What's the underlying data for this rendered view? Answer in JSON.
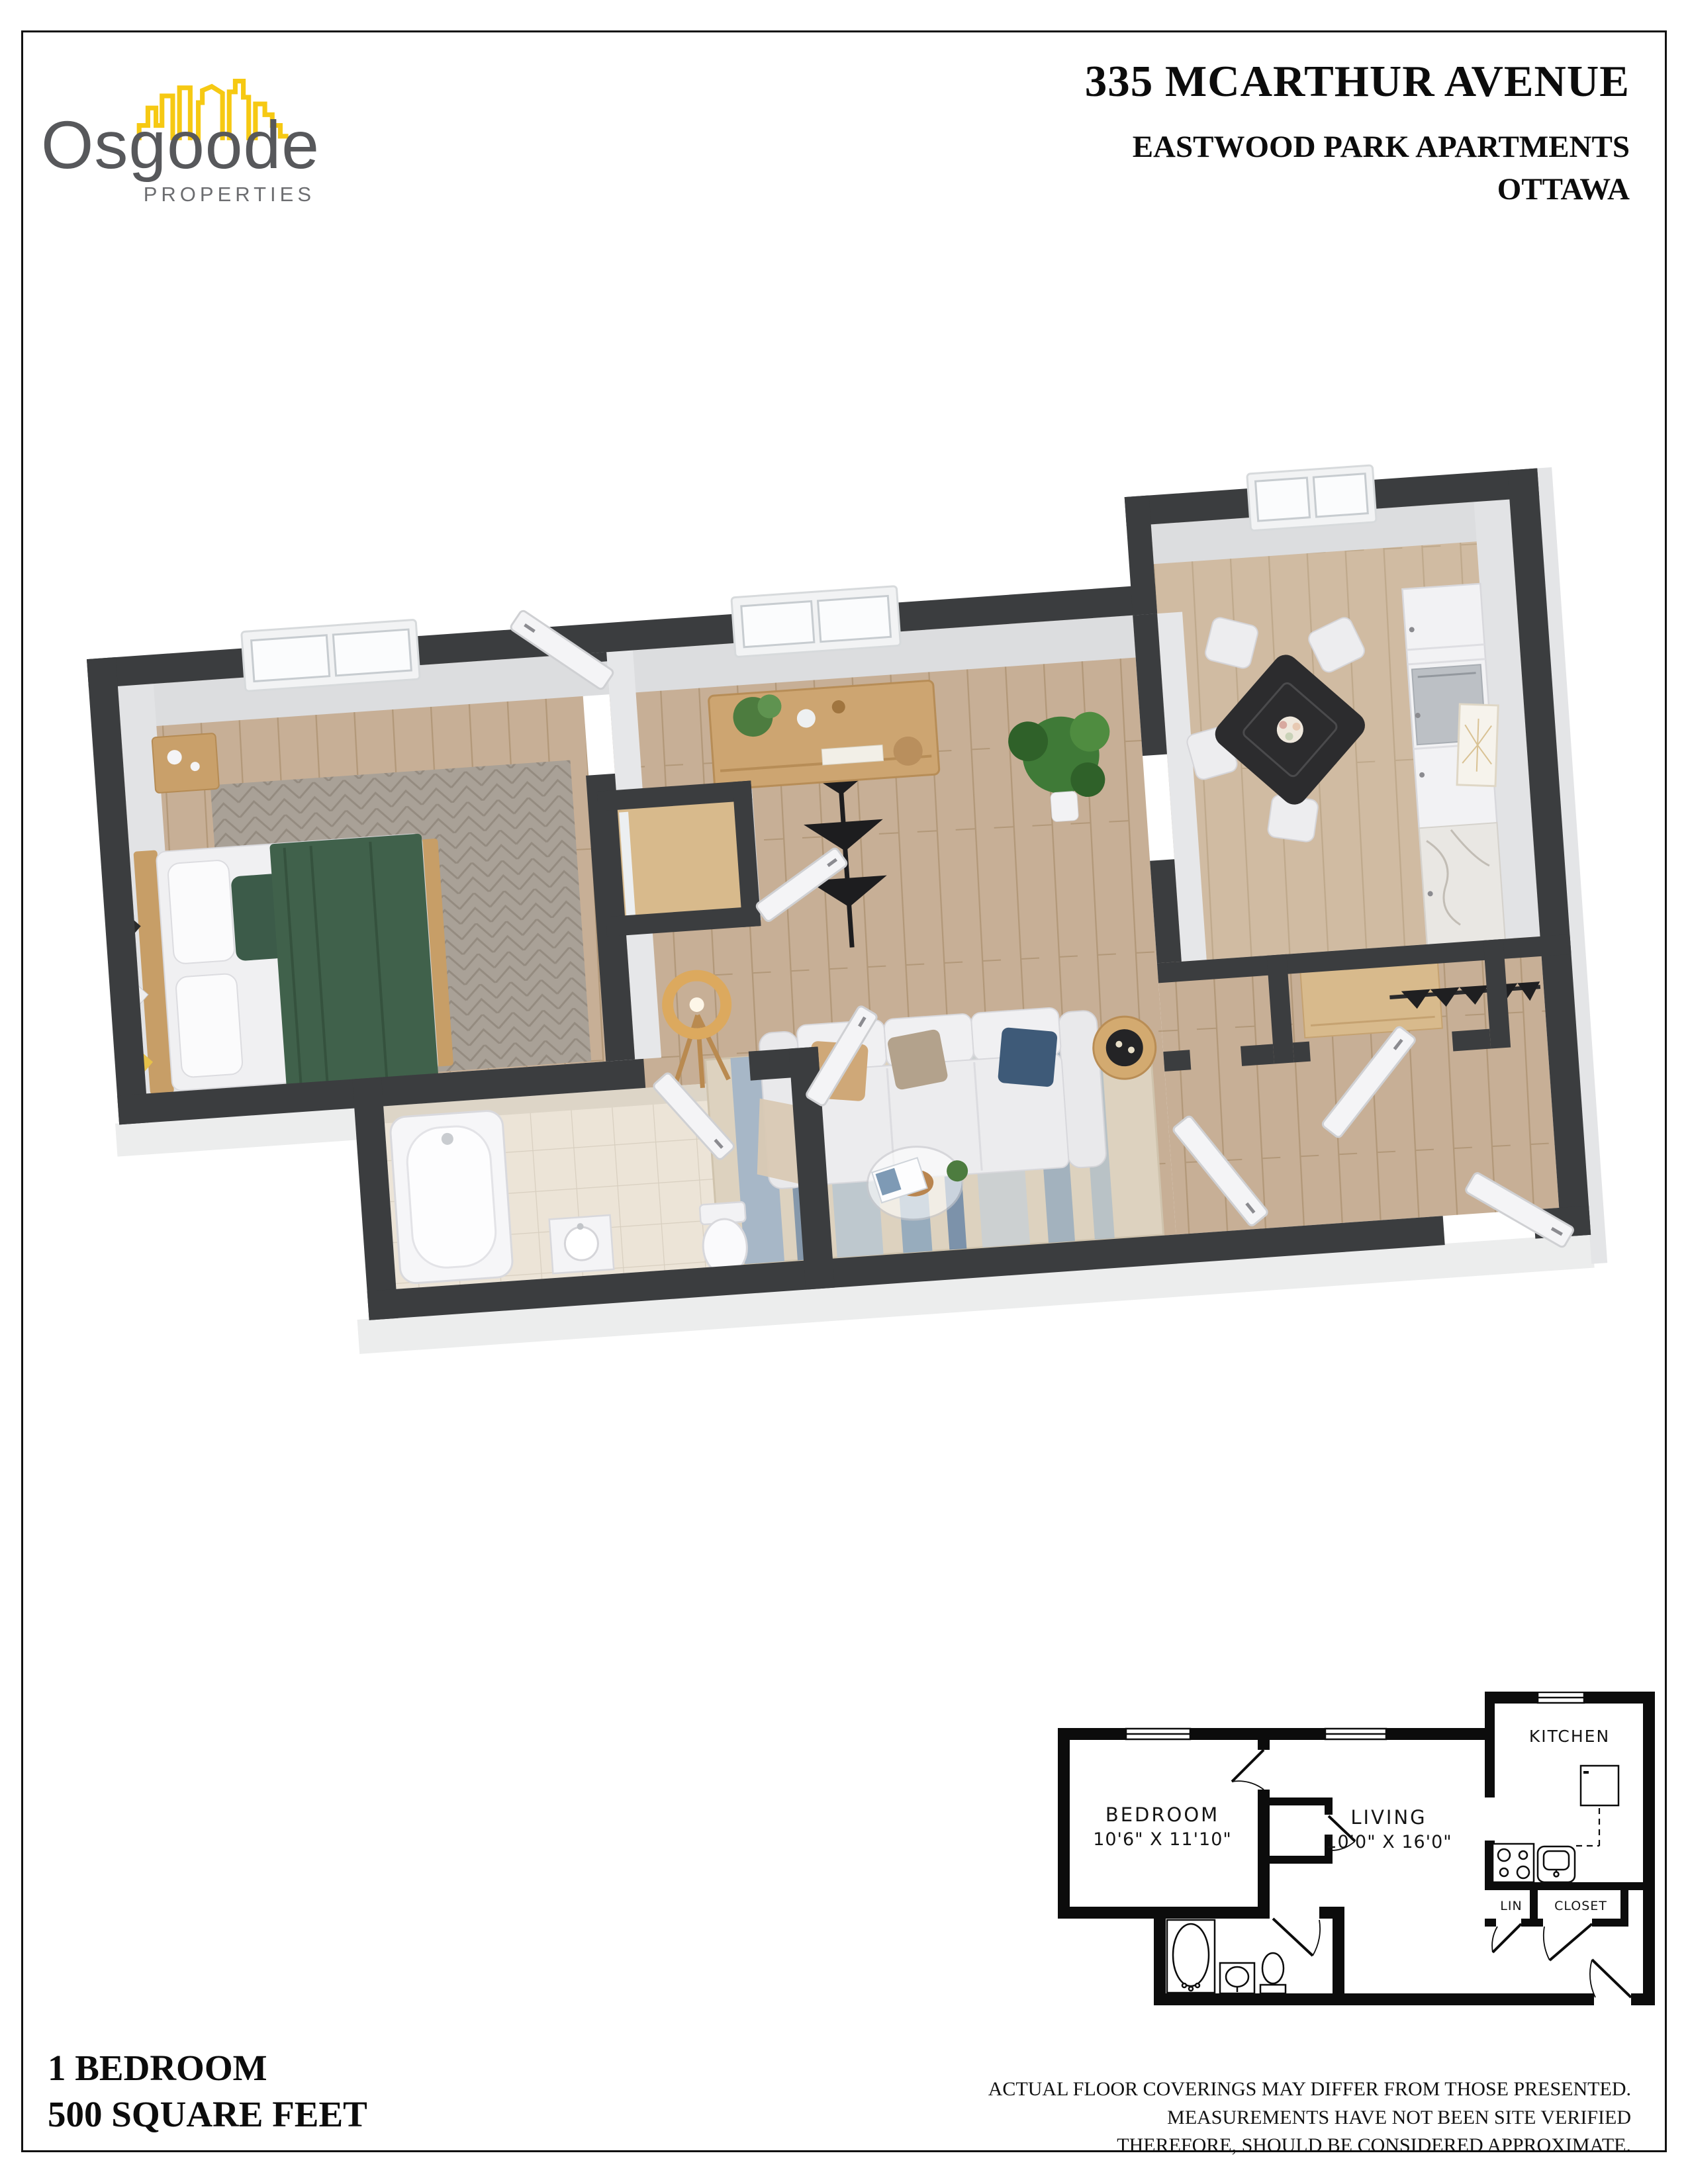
{
  "theme": {
    "accent_yellow": "#f6c913",
    "logo_gray": "#57585b",
    "wall_dark": "#3b3d3f",
    "wood_floor": "#c7af96",
    "tile_floor": "#ece4d7",
    "rug_blue": "#8fa7bd",
    "blanket_green": "#40614b"
  },
  "header": {
    "logo_name": "Osgoode",
    "logo_subtitle": "PROPERTIES",
    "address": "335 MCARTHUR AVENUE",
    "building": "EASTWOOD PARK APARTMENTS",
    "city": "OTTAWA"
  },
  "floorplan_2d": {
    "bedroom_label": "BEDROOM",
    "bedroom_dims": "10'6\" X 11'10\"",
    "living_label": "LIVING",
    "living_dims": "10'0\" X 16'0\"",
    "kitchen_label": "KITCHEN",
    "lin_label": "LIN",
    "closet_label": "CLOSET"
  },
  "footer": {
    "unit_type": "1 BEDROOM",
    "unit_area": "500 SQUARE FEET",
    "disclaimer": [
      "ACTUAL FLOOR COVERINGS MAY DIFFER FROM THOSE PRESENTED.",
      "MEASUREMENTS HAVE NOT BEEN SITE VERIFIED",
      "THEREFORE, SHOULD BE CONSIDERED APPROXIMATE."
    ]
  }
}
